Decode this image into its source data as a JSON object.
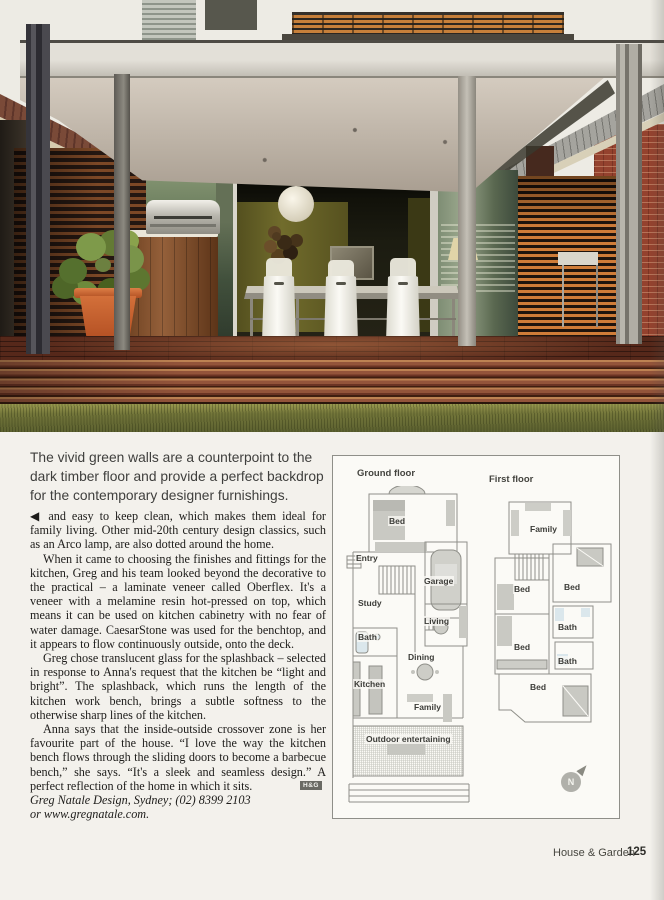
{
  "colors": {
    "deck_brown": "#7a4028",
    "grass_green": "#73763a",
    "feature_wall_green": "#716c2c",
    "steel_gray": "#b4b0a6",
    "brick_red": "#94422e",
    "terracotta": "#cf6a34"
  },
  "caption": {
    "lines": [
      "The vivid green walls are a counterpoint to the",
      "dark timber floor and provide a perfect backdrop",
      "for the contemporary designer furnishings."
    ]
  },
  "article": {
    "paragraphs": [
      "◀ and easy to keep clean, which makes them ideal for family living. Other mid-20th century design classics, such as an Arco lamp, are also dotted around the home.",
      "When it came to choosing the finishes and fittings for the kitchen, Greg and his team looked beyond the decorative to the practical – a laminate veneer called Oberflex. It's a veneer with a melamine resin hot-pressed on top, which means it can be used on kitchen cabinetry with no fear of water damage. CaesarStone was used for the benchtop, and it appears to flow continuously outside, onto the deck.",
      "Greg chose translucent glass for the splashback – selected in response to Anna's request that the kitchen be “light and bright”. The splashback, which runs the length of the kitchen work bench, brings a subtle softness to the otherwise sharp lines of the kitchen.",
      "Anna says that the inside-outside crossover zone is her favourite part of the house. “I love the way the kitchen bench flows through the sliding doors to become a barbecue bench,” she says. “It's a sleek and seamless design.” A perfect reflection of the home in which it sits."
    ],
    "end_badge": "H&G",
    "credits": [
      "Greg Natale Design, Sydney; (02) 8399 2103",
      "or www.gregnatale.com."
    ]
  },
  "floorplan": {
    "ground_title": "Ground floor",
    "first_title": "First floor",
    "ground_rooms": [
      "Bed",
      "Entry",
      "Garage",
      "Study",
      "Living",
      "Bath",
      "Dining",
      "Kitchen",
      "Family",
      "Outdoor entertaining"
    ],
    "first_rooms": [
      "Family",
      "Bed",
      "Bed",
      "Bath",
      "Bed",
      "Bath",
      "Bed"
    ],
    "compass": "N"
  },
  "footer": {
    "brand": "House & Garden",
    "page_number": "125"
  }
}
